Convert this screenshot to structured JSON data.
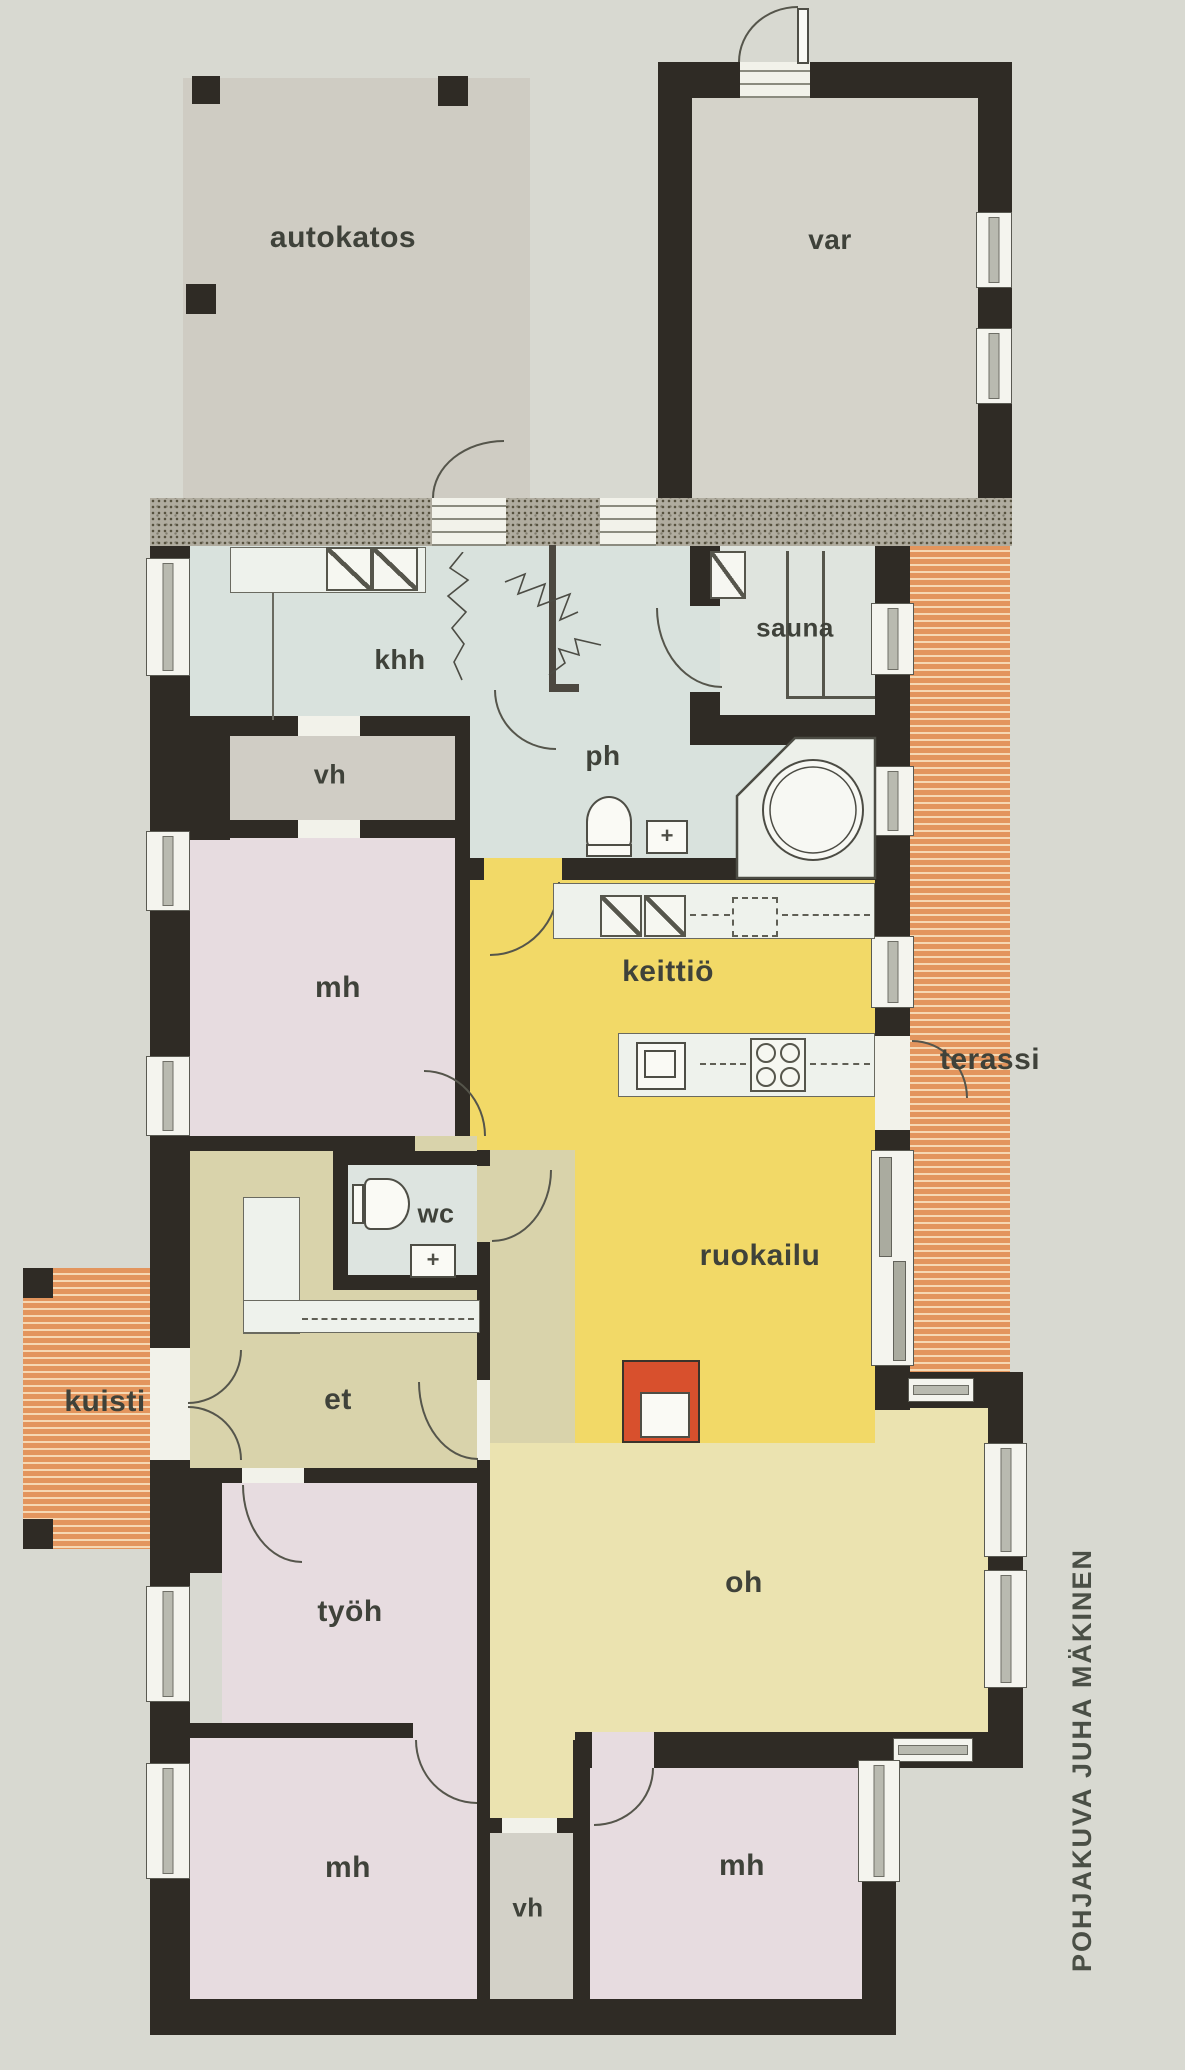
{
  "rooms": {
    "autokatos": "autokatos",
    "var": "var",
    "khh": "khh",
    "sauna": "sauna",
    "ph": "ph",
    "vh_top": "vh",
    "mh_top": "mh",
    "keittio": "keittiö",
    "terassi": "terassi",
    "wc": "wc",
    "ruokailu": "ruokailu",
    "et": "et",
    "kuisti": "kuisti",
    "tyoh": "työh",
    "oh": "oh",
    "mh_bottom_left": "mh",
    "vh_bottom": "vh",
    "mh_bottom_right": "mh"
  },
  "credit": "POHJAKUVA JUHA MÄKINEN",
  "colors": {
    "wall": "#2f2b25",
    "paper": "#d8d9d1",
    "carport": "#cfccc3",
    "storage": "#d5d3ca",
    "wetroom": "#d9e2dd",
    "sauna_room": "#dfe4de",
    "closet": "#d0cdc5",
    "bedroom": "#e7dce0",
    "kitchen_dining": "#f2d967",
    "hall": "#d9d3ab",
    "living": "#ebe3b0",
    "terrace_stripe": "#e3955d",
    "terrace_stripe_light": "#f6d8b3",
    "fireplace": "#d8502d",
    "label_text": "#3f423a"
  }
}
